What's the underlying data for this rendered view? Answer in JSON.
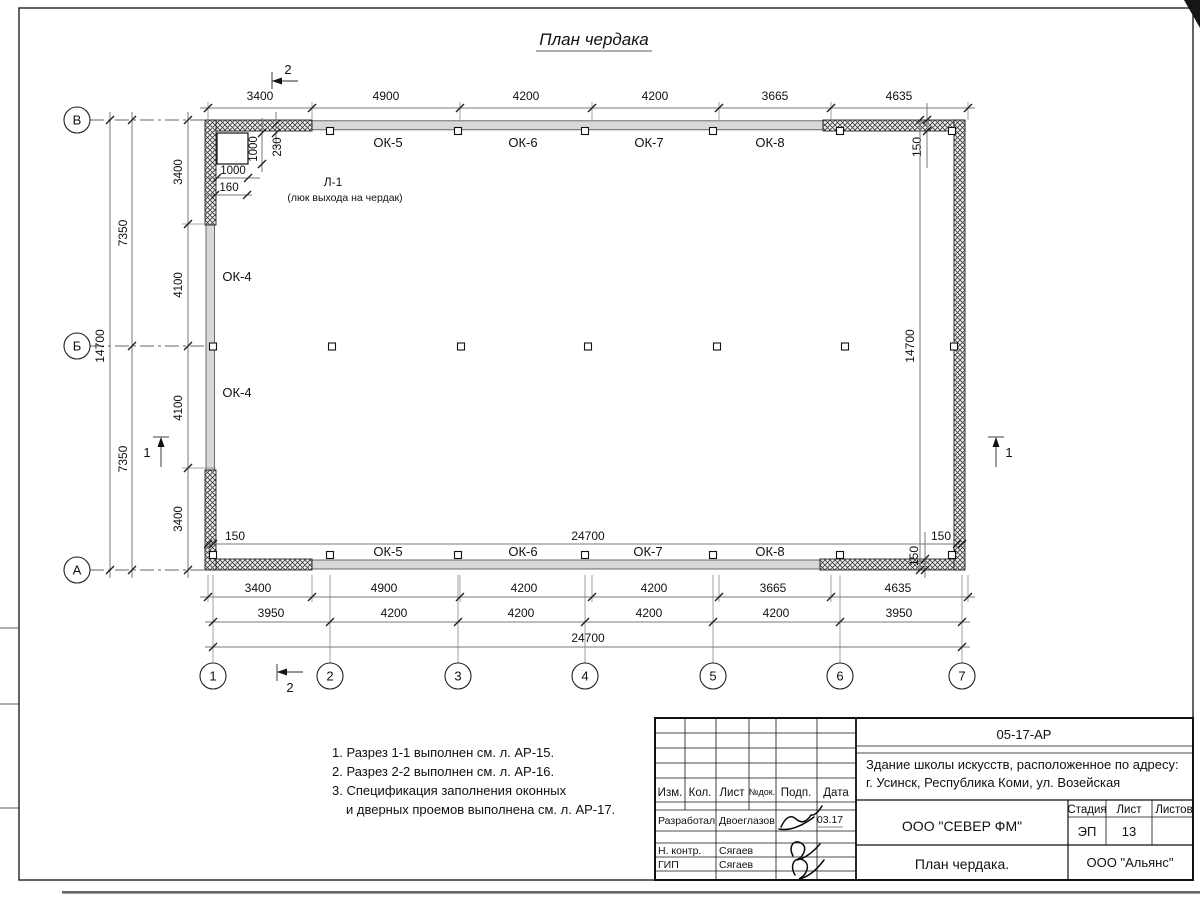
{
  "page": {
    "title": "План чердака"
  },
  "plan": {
    "axis_cols": [
      "1",
      "2",
      "3",
      "4",
      "5",
      "6",
      "7"
    ],
    "axis_rows": [
      "В",
      "Б",
      "А"
    ],
    "section_marks": {
      "s1": "1",
      "s2": "2"
    },
    "top_dims": [
      "3400",
      "4900",
      "4200",
      "4200",
      "3665",
      "4635"
    ],
    "top_windows": [
      "ОК-5",
      "ОК-6",
      "ОК-7",
      "ОК-8"
    ],
    "bottom_windows": [
      "ОК-5",
      "ОК-6",
      "ОК-7",
      "ОК-8"
    ],
    "left_windows": [
      "ОК-4",
      "ОК-4"
    ],
    "left_dims_seg": [
      "3400",
      "4100",
      "4100",
      "3400"
    ],
    "left_dims_half": [
      "7350",
      "7350"
    ],
    "left_total": "14700",
    "right_inner_height": "14700",
    "inner_width": "24700",
    "offset_left": "150",
    "offset_right": "150",
    "offset_top_right_v": "150",
    "offset_bottom_right_v": "150",
    "bottom_dims_row1": [
      "3400",
      "4900",
      "4200",
      "4200",
      "3665",
      "4635"
    ],
    "bottom_dims_row2": [
      "3950",
      "4200",
      "4200",
      "4200",
      "4200",
      "3950"
    ],
    "bottom_total": "24700",
    "hatch_detail": {
      "v1000": "1000",
      "v230": "230",
      "h1000": "1000",
      "h160": "160",
      "label": "Л-1",
      "sublabel": "(люк выхода на чердак)"
    }
  },
  "notes": {
    "lines": [
      "1. Разрез 1-1 выполнен см. л. АР-15.",
      "2. Разрез 2-2 выполнен см. л. АР-16.",
      "3. Спецификация заполнения оконных",
      "и дверных проемов выполнена см. л. АР-17."
    ]
  },
  "titleblock": {
    "doc_number": "05-17-АР",
    "project_line1": "Здание школы искусств, расположенное по адресу:",
    "project_line2": "г. Усинск, Республика Коми, ул. Возейская",
    "cols": [
      "Изм.",
      "Кол.",
      "Лист",
      "№док.",
      "Подп.",
      "Дата"
    ],
    "row1_role": "Разработал",
    "row1_name": "Двоеглазов",
    "row1_date": "03.17",
    "row2_role": "Н. контр.",
    "row2_name": "Сягаев",
    "row3_role": "ГИП",
    "row3_name": "Сягаев",
    "company": "ООО \"СЕВЕР ФМ\"",
    "stage_label": "Стадия",
    "sheet_label": "Лист",
    "sheets_label": "Листов",
    "stage_value": "ЭП",
    "sheet_value": "13",
    "drawing_title": "План чердака.",
    "company2": "ООО \"Альянс\""
  }
}
